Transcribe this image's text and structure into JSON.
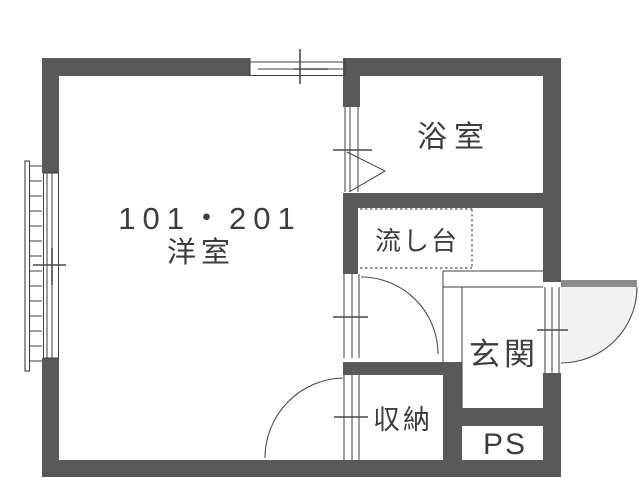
{
  "plan": {
    "rooms": {
      "main": {
        "number": "101・201",
        "name": "洋室"
      },
      "bath": {
        "name": "浴室"
      },
      "sink": {
        "name": "流し台"
      },
      "entrance": {
        "name": "玄関"
      },
      "closet": {
        "name": "収納"
      },
      "pipe_space": {
        "name": "PS"
      }
    },
    "symbols": {
      "window_top": "sliding-window",
      "window_left": "sliding-window-with-balcony-railing",
      "bath_door": "folding-door",
      "hall_door": "hinged-door",
      "closet_door": "hinged-door",
      "front_door": "outward-hinged-entry-door"
    },
    "colors": {
      "wall": "#595959",
      "line": "#3f3f3f",
      "text": "#3d3d3d",
      "door_leaf": "#8c8c8c",
      "door_swing_fill": "#f2f2f2",
      "background": "#ffffff"
    }
  }
}
